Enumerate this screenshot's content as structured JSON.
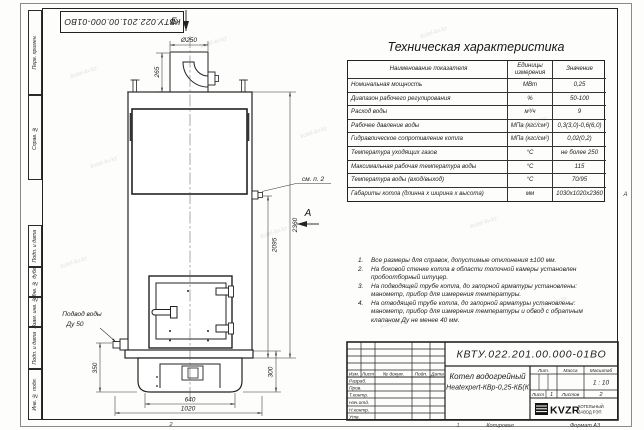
{
  "watermark": {
    "text": "kotel-kv.kz"
  },
  "frame": {
    "zone_bottom": "2",
    "copy_col_num": "1",
    "copied_label": "Копировал",
    "format_label": "Формат А3",
    "zone_right": "А",
    "margin_labels": [
      "Перв. примен.",
      "Справ. №",
      "Подп. и дата",
      "Инв. № дубл.",
      "Взам. инв. №",
      "Подп. и дата",
      "Инв. № подл."
    ]
  },
  "drawing": {
    "view_b": "Б",
    "view_a": "А",
    "see_note": "см. п. 2",
    "inlet_line1": "Подвод воды",
    "inlet_line2": "Ду 50",
    "dims": {
      "d250": "Ø250",
      "h265": "265",
      "h2360": "2360",
      "h2095": "2095",
      "h350": "350",
      "h300": "300",
      "w640": "640",
      "w1020": "1020"
    }
  },
  "spec_table": {
    "title": "Техническая характеристика",
    "headers": {
      "name": "Наименование показателя",
      "units": "Единицы измерения",
      "value": "Значение"
    },
    "rows": [
      {
        "name": "Номинальная мощность",
        "units": "МВт",
        "value": "0,25"
      },
      {
        "name": "Диапазон рабочего регулирования",
        "units": "%",
        "value": "50-100"
      },
      {
        "name": "Расход воды",
        "units": "м³/ч",
        "value": "9"
      },
      {
        "name": "Рабочее давление воды",
        "units": "МПа (кгс/см²)",
        "value": "0,3(3,0)-0,6(6,0)"
      },
      {
        "name": "Гидравлическое сопротивление котла",
        "units": "МПа (кгс/см²)",
        "value": "0,02(0,2)"
      },
      {
        "name": "Температура уходящих газов",
        "units": "°С",
        "value": "не более 250"
      },
      {
        "name": "Максимальная рабочая температура воды",
        "units": "°С",
        "value": "115"
      },
      {
        "name": "Температура воды (вход/выход)",
        "units": "°С",
        "value": "70/95"
      },
      {
        "name": "Габариты котла (длинна х ширина х высота)",
        "units": "мм",
        "value": "1030х1020х2360"
      }
    ]
  },
  "notes": {
    "items": [
      {
        "num": "1.",
        "text": "Все размеры для справок, допустимые отклонения ±100 мм."
      },
      {
        "num": "2.",
        "text": "На боковой стенке котла в области топочной камеры установлен пробоотборный штуцер."
      },
      {
        "num": "3.",
        "text": "На подводящей трубе котла, до запорной арматуры установлены: манометр, прибор для измерения температуры."
      },
      {
        "num": "4.",
        "text": "На отводящей трубе котла, до запорной арматуры установлены: манометр, прибор для измерения температуры и обвод с обратным клапаном Ду не менее 40 мм."
      }
    ]
  },
  "title_block": {
    "doc_number": "КВТУ.022.201.00.000-01ВО",
    "product_name_1": "Котел водогрейный",
    "product_name_2": "Heatexpert-КВр-0,25-КБ(К",
    "header_cells": [
      "Изм.",
      "Лист",
      "№ докум.",
      "Подп.",
      "Дата"
    ],
    "sig_rows": [
      "Разраб.",
      "Пров.",
      "Т.контр.",
      "Нач.отд.",
      "Н.контр.",
      "Утв."
    ],
    "lit_label": "Лит.",
    "mass_label": "Масса",
    "scale_label": "Масштаб",
    "scale_value": "1 : 10",
    "sheet_label": "Лист",
    "sheet_value": "1",
    "sheets_label": "Листов",
    "sheets_value": "2",
    "logo_text": "KVZR",
    "company_line_1": "КОТЕЛЬНЫЙ",
    "company_line_2": "ЗАВОД РЭП"
  }
}
